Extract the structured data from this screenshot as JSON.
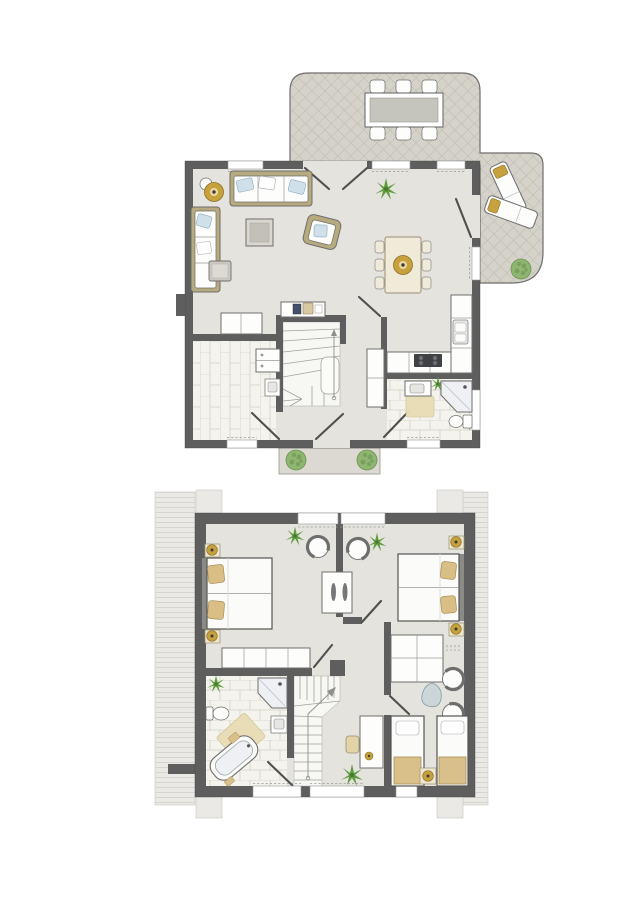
{
  "figure": {
    "type": "architectural-floor-plan",
    "description": "Two-storey holiday-house floor plan, top-down colored drawing, no text labels",
    "floors": [
      {
        "key": "ground",
        "label": "ground floor with terrace and entrance porch",
        "rooms": [
          "terrace",
          "living-room",
          "dining-area",
          "kitchen",
          "hallway",
          "staircase",
          "utility-room",
          "bathroom",
          "entrance-porch"
        ],
        "furniture": {
          "terrace": [
            "outdoor-dining-table",
            "outdoor-chair x6",
            "sun-lounger x2",
            "shrub"
          ],
          "living-room": [
            "sofa-top",
            "sofa-left",
            "floor-lamp",
            "side-table",
            "coffee-table",
            "armchair",
            "pouf",
            "sideboard",
            "desk",
            "plant"
          ],
          "dining-area": [
            "dining-table",
            "dining-chair x6",
            "pendant-lamp"
          ],
          "kitchen": [
            "counter-L",
            "sink",
            "cooktop"
          ],
          "utility-room": [
            "washer-dryer",
            "utility-sink"
          ],
          "bathroom": [
            "vanity-sink",
            "corner-shower",
            "toilet",
            "rug",
            "plant"
          ],
          "hallway": [
            "closet",
            "front-door"
          ],
          "entrance-porch": [
            "shrub x2"
          ]
        }
      },
      {
        "key": "upper",
        "label": "upper floor with three bedrooms and bathroom",
        "rooms": [
          "bedroom-left",
          "bedroom-right",
          "bedroom-bottom",
          "landing",
          "staircase",
          "bathroom",
          "roof-areas"
        ],
        "furniture": {
          "bedroom-left": [
            "double-bed",
            "nightstand-with-lamp x2",
            "wardrobe-4-door",
            "armchair",
            "plant"
          ],
          "bedroom-right": [
            "double-bed",
            "nightstand-with-lamp x2",
            "wardrobe-grid",
            "double-sided-cabinet",
            "armchair x3",
            "side-table",
            "plant",
            "single-bed x2",
            "nightstand-with-lamp"
          ],
          "landing": [
            "desk",
            "desk-chair",
            "plant"
          ],
          "bathroom": [
            "corner-shower",
            "toilet",
            "corner-bathtub",
            "sink",
            "rug",
            "plant",
            "towel x2"
          ]
        }
      }
    ]
  },
  "palette": {
    "wall": "#5e5e5e",
    "floor": "#e4e3dd",
    "terrace": "#d5d2c9",
    "terraceLine": "#c2bfb4",
    "roof": "#eae9e5",
    "roofLine": "#d6d4ce",
    "tile": "#f4f3ed",
    "tileLine": "#d2d0c7",
    "porch": "#dbd9d2",
    "line": "#6e6e6e",
    "furnW": "#fdfdfc",
    "tan": "#b6aa7e",
    "pillow": "#cfe0ea",
    "gold": "#c7a13d",
    "green": "#5f9a3e",
    "greenDark": "#477a2d",
    "bush": "#8fb573",
    "bushDark": "#6d9452",
    "rug": "#e8dcb4",
    "shower": "#eef0f3",
    "cook": "#3f4145",
    "tableTop": "#c6c5bd",
    "cream": "#f0ead9"
  }
}
